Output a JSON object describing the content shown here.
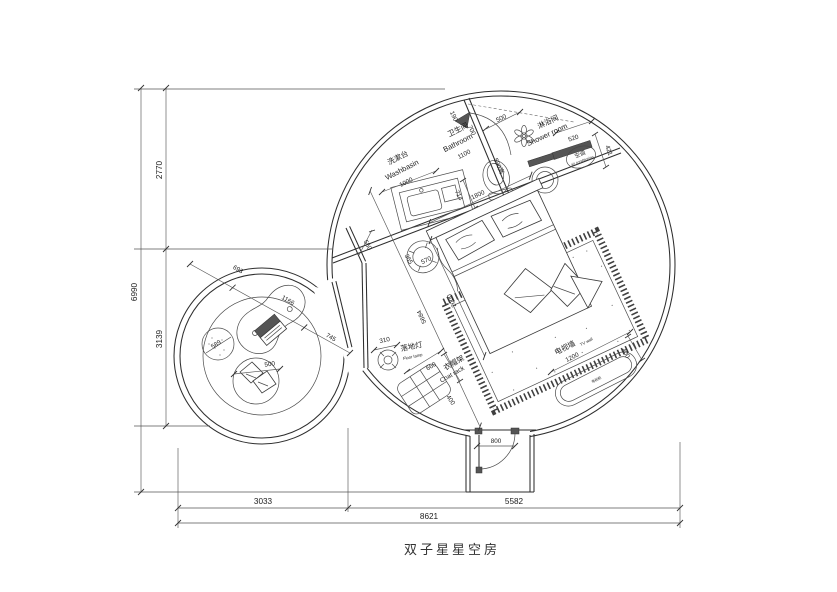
{
  "title": "双子星星空房",
  "rooms": {
    "washbasin_zh": "洗漱台",
    "washbasin_en": "Washbasin",
    "bathroom_zh": "卫生间",
    "bathroom_en": "Bathroom",
    "shower_zh": "淋浴间",
    "shower_en": "Shower room",
    "ac_zh": "空调",
    "ac_en": "air conditioning",
    "lamp_zh": "落地灯",
    "lamp_en": "Floor lamp",
    "rack_zh": "衣帽架",
    "rack_en": "Coat rack",
    "tvwall_zh": "电视墙",
    "tvwall_en": "TV wall",
    "tvcab_zh": "电视柜"
  },
  "dims": {
    "v_total": "6990",
    "v_upper": "2770",
    "v_lower": "3139",
    "h_total": "8621",
    "h_left": "3033",
    "h_right": "5582",
    "washbasin_w": "1000",
    "washbasin_d": "550",
    "bathroom_w": "1100",
    "wall_seg": "190",
    "wall_b": "700",
    "shower_opening": "500",
    "partition": "590高",
    "ac_w": "520",
    "ac_offset": "421",
    "toilet_c": "714",
    "bed_w": "1800",
    "bed_l": "2000",
    "diagonal": "5684",
    "stool_a": "365",
    "stool_b": "570",
    "lounge_a": "693",
    "lounge_b": "1166",
    "lounge_c": "745",
    "pouf_d": "589",
    "chair_d": "500",
    "lamp_d": "310",
    "rack_w": "660",
    "rack_d": "400",
    "tv_w": "1200",
    "tv_d": "400",
    "door_w": "800"
  }
}
